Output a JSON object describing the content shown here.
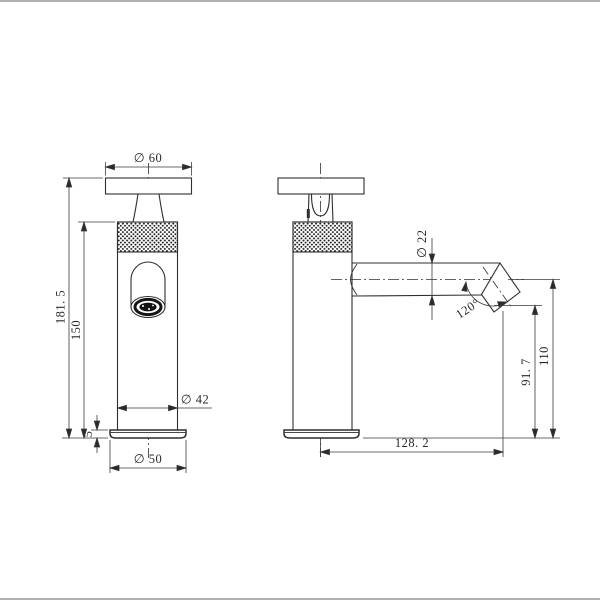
{
  "drawing": {
    "kind": "faucet two-view technical dimension drawing",
    "line_color": "#2f2f2f",
    "dimension_line_color": "#3a3a3a",
    "frame_rule_color": "#b0b0b0",
    "background_color": "#ffffff",
    "dimensions": {
      "front": {
        "handle_diameter": "∅ 60",
        "overall_height": "181. 5",
        "body_height": "150",
        "base_thickness": "5",
        "body_diameter": "∅ 42",
        "base_diameter": "∅ 50"
      },
      "side": {
        "spout_tube_diameter": "∅ 22",
        "outlet_angle": "120°",
        "outlet_height": "91. 7",
        "spout_axis_height": "110",
        "spout_reach": "128. 2"
      }
    }
  }
}
